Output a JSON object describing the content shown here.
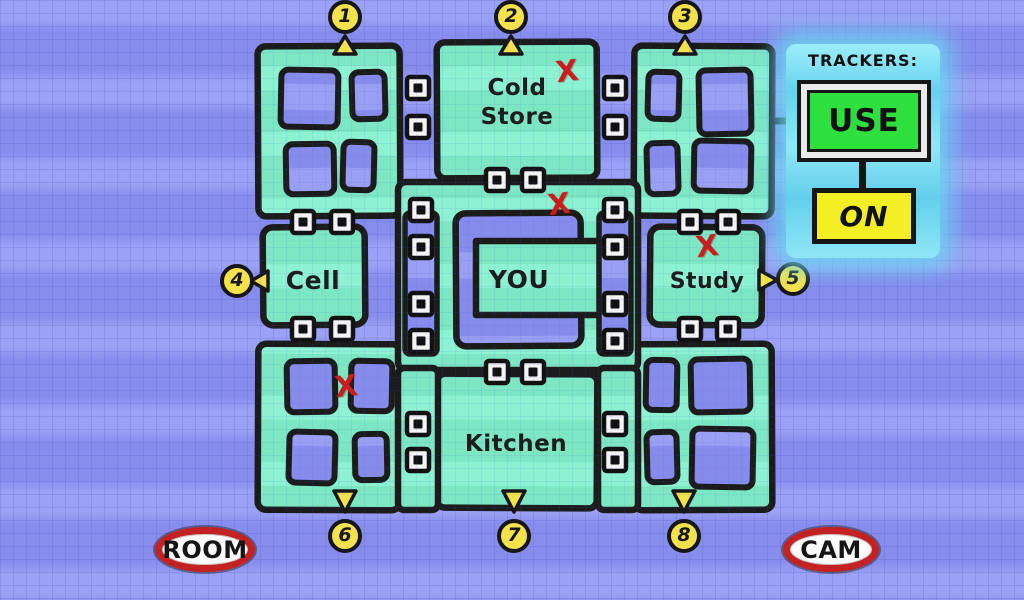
{
  "map": {
    "rooms": [
      {
        "id": "cold-store",
        "label": "Cold Store"
      },
      {
        "id": "cell",
        "label": "Cell"
      },
      {
        "id": "you",
        "label": "YOU"
      },
      {
        "id": "study",
        "label": "Study"
      },
      {
        "id": "kitchen",
        "label": "Kitchen"
      }
    ],
    "exits": [
      {
        "number": "1"
      },
      {
        "number": "2"
      },
      {
        "number": "3"
      },
      {
        "number": "4"
      },
      {
        "number": "5"
      },
      {
        "number": "6"
      },
      {
        "number": "7"
      },
      {
        "number": "8"
      }
    ],
    "x_mark": "X",
    "x_mark_count": 4,
    "icons": {
      "door_marker": "door-marker-icon",
      "exit_arrow": "triangle-arrow-icon"
    }
  },
  "trackers": {
    "title": "TRACKERS:",
    "use_label": "USE",
    "on_label": "ON"
  },
  "footer": {
    "room_label": "ROOM",
    "cam_label": "CAM"
  },
  "colors": {
    "maze_green": "#7feac6",
    "background_blue": "#878dec",
    "background_blue_light": "#9ba1f4",
    "panel_cyan": "#6fd6ef",
    "exit_yellow": "#f3e24b",
    "use_green": "#2ee03e",
    "on_yellow": "#f4ef25",
    "mark_red": "#c81e1e",
    "oval_red": "#c42222",
    "wall_black": "#1b1b1b"
  }
}
